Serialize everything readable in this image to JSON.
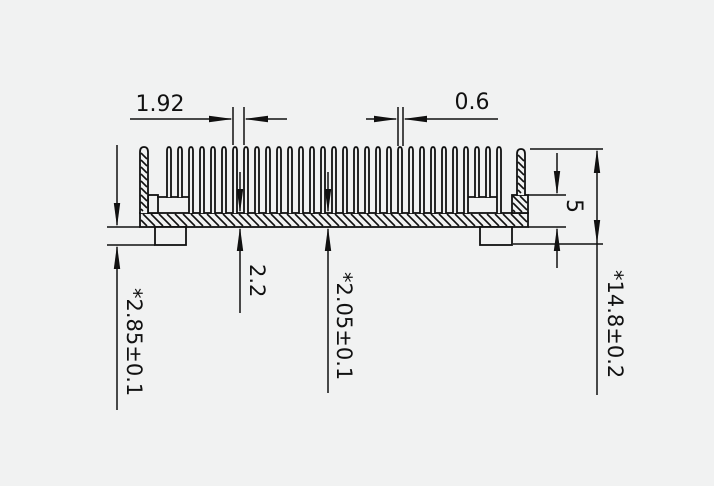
{
  "drawing": {
    "dimensions": {
      "fin_pitch": "1.92",
      "fin_thickness": "0.6",
      "base_thickness": "2.2",
      "base_groove_thickness": "*2.05±0.1",
      "standoff_height": "*2.85±0.1",
      "end_step_height": "5",
      "overall_height": "*14.8±0.2"
    },
    "colors": {
      "background": "#f1f2f2",
      "line": "#111111"
    }
  }
}
